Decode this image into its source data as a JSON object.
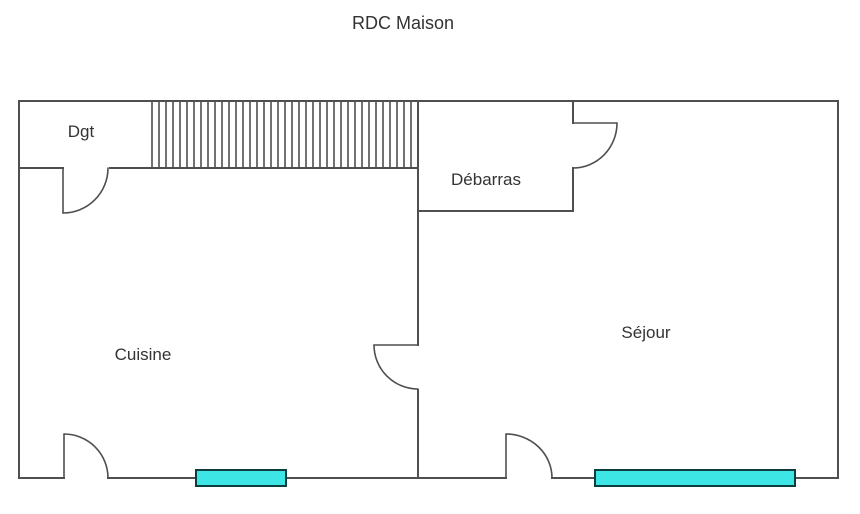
{
  "title": "RDC Maison",
  "rooms": {
    "hallway": "Dgt",
    "storage": "Débarras",
    "kitchen": "Cuisine",
    "living": "Séjour"
  },
  "colors": {
    "wall": "#4f4f4f",
    "text": "#333333",
    "window_fill": "#3de5e5",
    "window_border": "#0d3d3d",
    "background": "#ffffff"
  }
}
